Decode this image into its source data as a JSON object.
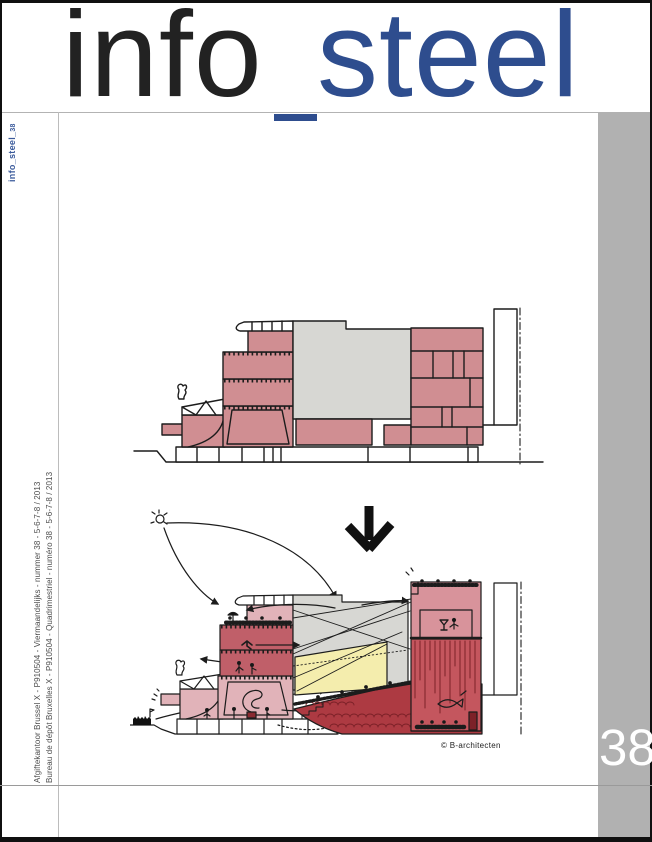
{
  "masthead": {
    "word_black": "info",
    "separator": "_",
    "word_blue": "steel"
  },
  "spine": {
    "logo_text": "info_steel_",
    "logo_number": "38"
  },
  "postal": {
    "line_nl": "Afgiftekantoor Brussel X - P910504 - Viermaandelijks - nummer 38 - 5-6-7-8 / 2013",
    "line_fr": "Bureau de dépôt Bruxelles X - P910504 - Quadrimestriel - numéro 38 - 5-6-7-8 / 2013"
  },
  "issue": {
    "number": "38"
  },
  "cover_art": {
    "credit": "© B-architecten"
  },
  "colors": {
    "masthead_black": "#222222",
    "masthead_blue": "#2e4d8e",
    "spine_blue": "#3a5a9b",
    "band_gray": "#b1b1b1",
    "drawing_pink": "#d08e92",
    "drawing_light_pink": "#e1b3b9",
    "drawing_medium_red": "#c05f69",
    "drawing_dark_red": "#ad3a42",
    "drawing_curtain_red": "#c4565e",
    "drawing_deep_red": "#7c2128",
    "drawing_yellow": "#f4edad",
    "drawing_gray": "#d7d7d3",
    "ink": "#1c1c1c"
  }
}
